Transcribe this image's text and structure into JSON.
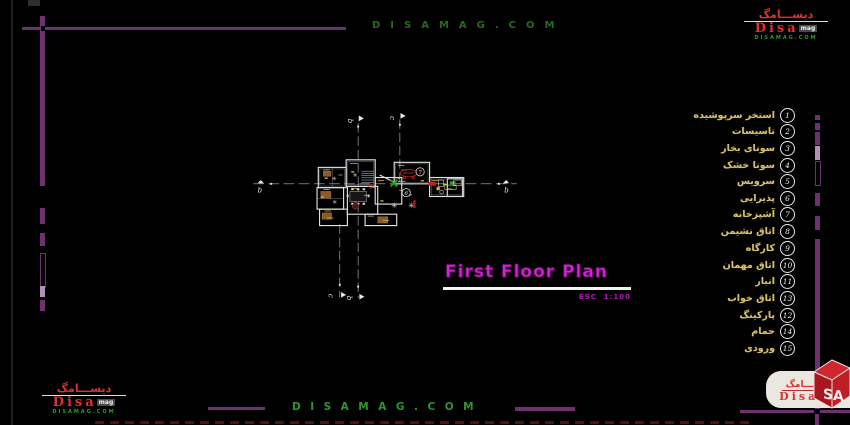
{
  "watermark_top": "DISAMAG.COM",
  "watermark_bottom": "DISAMAG.COM",
  "logo": {
    "persian": "دیســـامگ",
    "latin": "Disa",
    "suffix": "mag",
    "domain": "DISAMAG.COM",
    "cube": "SA"
  },
  "title_block": {
    "title": "First Floor Plan",
    "scale": "ESC  1:100"
  },
  "sections": {
    "b": "b",
    "c": "c"
  },
  "plan_labels": {
    "room6": "6",
    "room7": "7"
  },
  "legend": {
    "items": [
      {
        "num": "1",
        "label": "استخر سرپوشیده"
      },
      {
        "num": "2",
        "label": "تاسیسات"
      },
      {
        "num": "3",
        "label": "سونای بخار"
      },
      {
        "num": "4",
        "label": "سونا خشک"
      },
      {
        "num": "5",
        "label": "سرویس"
      },
      {
        "num": "6",
        "label": "پذیرایی"
      },
      {
        "num": "7",
        "label": "آشپزخانه"
      },
      {
        "num": "8",
        "label": "اتاق نشیمن"
      },
      {
        "num": "9",
        "label": "کارگاه"
      },
      {
        "num": "10",
        "label": "اتاق مهمان"
      },
      {
        "num": "11",
        "label": "انبار"
      },
      {
        "num": "13",
        "label": "اتاق خواب"
      },
      {
        "num": "12",
        "label": "پارکینگ"
      },
      {
        "num": "14",
        "label": "حمام"
      },
      {
        "num": "15",
        "label": "ورودی"
      }
    ]
  },
  "colors": {
    "frame_purple": "#6e3170",
    "legend_text": "#d6c06a",
    "title_magenta": "#d025d0",
    "watermark_green": "#2f9530",
    "plan_wall": "#e0e0e0",
    "accent_red": "#c02020",
    "accent_green": "#1faa1f",
    "accent_yellow": "#d8bc3c"
  }
}
